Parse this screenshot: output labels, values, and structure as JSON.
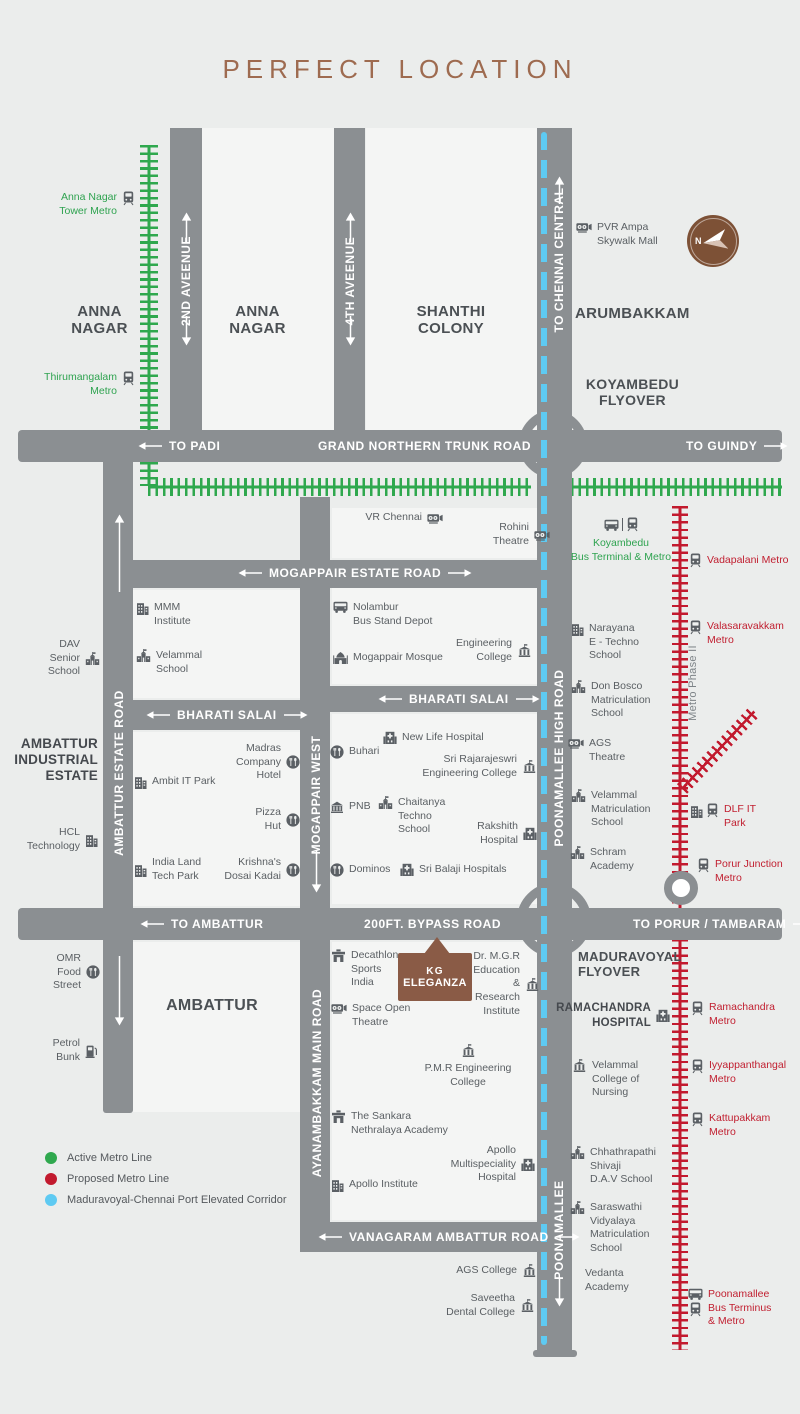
{
  "title": "PERFECT LOCATION",
  "compass": {
    "north_label": "N"
  },
  "project_marker": {
    "name_line1": "KG",
    "name_line2": "ELEGANZA"
  },
  "colors": {
    "active_metro": "#2fa84e",
    "proposed_metro": "#c21a2e",
    "elevated_corridor": "#5ecaf2",
    "road": "#8b8f92",
    "brand_brown": "#8a5b46",
    "title_brown": "#9e6b50"
  },
  "legend": {
    "items": [
      {
        "label": "Active Metro Line",
        "color": "#2fa84e"
      },
      {
        "label": "Proposed Metro Line",
        "color": "#c21a2e"
      },
      {
        "label": "Maduravoyal-Chennai Port Elevated Corridor",
        "color": "#5ecaf2"
      }
    ]
  },
  "road_labels": [
    {
      "id": "to-padi",
      "t": "TO PADI",
      "x": 138,
      "y": 439,
      "al": 1
    },
    {
      "id": "grand-northern-trunk-road",
      "t": "GRAND NORTHERN TRUNK ROAD",
      "x": 318,
      "y": 439
    },
    {
      "id": "to-guindy",
      "t": "TO GUINDY",
      "x": 686,
      "y": 439,
      "ar": 1
    },
    {
      "id": "mogappair-estate-road",
      "t": "MOGAPPAIR ESTATE ROAD",
      "x": 238,
      "y": 566,
      "al": 1,
      "ar": 1
    },
    {
      "id": "bharati-salai-west",
      "t": "BHARATI SALAI",
      "x": 146,
      "y": 708,
      "al": 1,
      "ar": 1
    },
    {
      "id": "bharati-salai-east",
      "t": "BHARATI SALAI",
      "x": 378,
      "y": 692,
      "al": 1,
      "ar": 1
    },
    {
      "id": "to-ambattur",
      "t": "TO AMBATTUR",
      "x": 140,
      "y": 917,
      "al": 1
    },
    {
      "id": "200ft-bypass-road",
      "t": "200FT. BYPASS ROAD",
      "x": 364,
      "y": 917
    },
    {
      "id": "to-porur-tambaram",
      "t": "TO PORUR / TAMBARAM",
      "x": 633,
      "y": 917,
      "ar": 1
    },
    {
      "id": "vanagaram-ambattur-road",
      "t": "VANAGARAM AMBATTUR ROAD",
      "x": 318,
      "y": 1230,
      "al": 1,
      "ar": 1
    },
    {
      "id": "2nd-avenue",
      "t": "2ND AVEENUE",
      "v": 1,
      "x": 186,
      "cy": 281
    },
    {
      "id": "4th-avenue",
      "t": "4TH AVEENUE",
      "v": 1,
      "x": 350,
      "cy": 281
    },
    {
      "id": "to-chennai-central",
      "t": "TO CHENNAI CENTRAL",
      "v": 1,
      "x": 559,
      "cy": 260
    },
    {
      "id": "ambattur-estate-road",
      "t": "AMBATTUR ESTATE ROAD",
      "v": 1,
      "x": 119,
      "cy": 773
    },
    {
      "id": "mogappair-west",
      "t": "MOGAPPAIR WEST",
      "v": 1,
      "x": 316,
      "cy": 795
    },
    {
      "id": "poonamallee-high-road",
      "t": "POONAMALLEE HIGH ROAD",
      "v": 1,
      "x": 559,
      "cy": 758
    },
    {
      "id": "ayanambakkam-main-road",
      "t": "AYANAMBAKKAM MAIN ROAD",
      "v": 1,
      "x": 317,
      "cy": 1083
    },
    {
      "id": "poonamallee",
      "t": "POONAMALLEE",
      "v": 1,
      "x": 559,
      "cy": 1230
    },
    {
      "id": "metro-phase-2",
      "t": "Metro Phase II",
      "v": 1,
      "x": 693,
      "cy": 683,
      "cls": "gray"
    }
  ],
  "area_labels": [
    {
      "id": "anna-nagar-west",
      "t": [
        "ANNA",
        "NAGAR"
      ],
      "x": 57,
      "y": 303,
      "w": 85,
      "a": "c"
    },
    {
      "id": "anna-nagar",
      "t": [
        "ANNA",
        "NAGAR"
      ],
      "x": 215,
      "y": 303,
      "w": 85,
      "a": "c"
    },
    {
      "id": "shanthi-colony",
      "t": [
        "SHANTHI",
        "COLONY"
      ],
      "x": 405,
      "y": 303,
      "w": 92,
      "a": "c"
    },
    {
      "id": "arumbakkam",
      "t": [
        "ARUMBAKKAM"
      ],
      "x": 575,
      "y": 305,
      "w": 130,
      "a": "l"
    },
    {
      "id": "koyambedu-flyover",
      "t": [
        "KOYAMBEDU",
        "FLYOVER"
      ],
      "x": 580,
      "y": 376,
      "w": 105,
      "a": "c",
      "sz": 14
    },
    {
      "id": "ambattur",
      "t": [
        "AMBATTUR"
      ],
      "x": 162,
      "y": 997,
      "w": 100,
      "a": "c",
      "sz": 16
    },
    {
      "id": "maduravoyal-flyover",
      "t": [
        "MADURAVOYAL",
        "FLYOVER"
      ],
      "x": 578,
      "y": 949,
      "w": 130,
      "a": "l",
      "sz": 13
    }
  ],
  "landmarks": [
    {
      "id": "anna-nagar-tower-metro",
      "t": [
        "Anna Nagar",
        "Tower Metro"
      ],
      "x": 40,
      "y": 191,
      "w": 95,
      "a": "r",
      "c": "g",
      "i": "train",
      "s": "r"
    },
    {
      "id": "thirumangalam-metro",
      "t": [
        "Thirumangalam",
        "Metro"
      ],
      "x": 25,
      "y": 371,
      "w": 110,
      "a": "r",
      "c": "g",
      "i": "train",
      "s": "r"
    },
    {
      "id": "pvr-ampa-skywalk-mall",
      "t": [
        "PVR Ampa",
        "Skywalk Mall"
      ],
      "x": 576,
      "y": 221,
      "w": 100,
      "a": "l",
      "i": "cinema",
      "s": "l"
    },
    {
      "id": "vr-chennai",
      "t": [
        "VR Chennai"
      ],
      "x": 363,
      "y": 511,
      "w": 80,
      "a": "r",
      "i": "cinema",
      "s": "r",
      "vc": 1
    },
    {
      "id": "rohini-theatre",
      "t": [
        "Rohini",
        "Theatre"
      ],
      "x": 460,
      "y": 521,
      "w": 90,
      "a": "r",
      "i": "cinema",
      "s": "r",
      "vc": 1
    },
    {
      "id": "koyambedu-bus-terminal-metro",
      "t": [
        "Koyambedu",
        "Bus Terminal & Metro"
      ],
      "x": 565,
      "y": 517,
      "w": 112,
      "a": "c",
      "c": "g",
      "i": "bus|train",
      "s": "t"
    },
    {
      "id": "vadapalani-metro",
      "t": [
        "Vadapalani Metro"
      ],
      "x": 689,
      "y": 553,
      "w": 100,
      "a": "l",
      "c": "r",
      "i": "train",
      "s": "l",
      "vc": 1
    },
    {
      "id": "valasaravakkam-metro",
      "t": [
        "Valasaravakkam",
        "Metro"
      ],
      "x": 689,
      "y": 620,
      "w": 100,
      "a": "l",
      "c": "r",
      "i": "train",
      "s": "l"
    },
    {
      "id": "mmm-institute",
      "t": [
        "MMM",
        "Institute"
      ],
      "x": 136,
      "y": 601,
      "w": 75,
      "a": "l",
      "i": "building",
      "s": "l"
    },
    {
      "id": "velammal-school",
      "t": [
        "Velammal",
        "School"
      ],
      "x": 136,
      "y": 649,
      "w": 75,
      "a": "l",
      "i": "school",
      "s": "l"
    },
    {
      "id": "nolambur-bus-stand-depot",
      "t": [
        "Nolambur",
        "Bus Stand Depot"
      ],
      "x": 333,
      "y": 601,
      "w": 100,
      "a": "l",
      "i": "bus",
      "s": "l"
    },
    {
      "id": "mogappair-mosque",
      "t": [
        "Mogappair Mosque"
      ],
      "x": 333,
      "y": 651,
      "w": 112,
      "a": "l",
      "i": "mosque",
      "s": "l",
      "vc": 1
    },
    {
      "id": "engineering-college",
      "t": [
        "Engineering",
        "College"
      ],
      "x": 435,
      "y": 637,
      "w": 97,
      "a": "r",
      "i": "college",
      "s": "r",
      "vc": 1
    },
    {
      "id": "dav-senior-school",
      "t": [
        "DAV",
        "Senior",
        "School"
      ],
      "x": 28,
      "y": 638,
      "w": 72,
      "a": "r",
      "i": "school",
      "s": "r",
      "vc": 1
    },
    {
      "id": "narayana-e-techno-school",
      "t": [
        "Narayana",
        "E - Techno",
        "School"
      ],
      "x": 571,
      "y": 622,
      "w": 80,
      "a": "l",
      "i": "building",
      "s": "l"
    },
    {
      "id": "don-bosco-matriculation-school",
      "t": [
        "Don Bosco",
        "Matriculation",
        "School"
      ],
      "x": 571,
      "y": 680,
      "w": 85,
      "a": "l",
      "i": "school",
      "s": "l"
    },
    {
      "id": "ags-theatre",
      "t": [
        "AGS",
        "Theatre"
      ],
      "x": 568,
      "y": 737,
      "w": 65,
      "a": "l",
      "i": "cinema",
      "s": "l"
    },
    {
      "id": "velammal-matriculation-school",
      "t": [
        "Velammal",
        "Matriculation",
        "School"
      ],
      "x": 571,
      "y": 789,
      "w": 85,
      "a": "l",
      "i": "school",
      "s": "l"
    },
    {
      "id": "dlf-it-park",
      "t": [
        "DLF IT",
        "Park"
      ],
      "x": 690,
      "y": 803,
      "w": 62,
      "a": "l",
      "c": "r",
      "i": "building+train",
      "s": "l"
    },
    {
      "id": "schram-academy",
      "t": [
        "Schram",
        "Academy"
      ],
      "x": 570,
      "y": 846,
      "w": 70,
      "a": "l",
      "i": "school",
      "s": "l"
    },
    {
      "id": "porur-junction-metro",
      "t": [
        "Porur Junction",
        "Metro"
      ],
      "x": 697,
      "y": 858,
      "w": 95,
      "a": "l",
      "c": "r",
      "i": "train",
      "s": "l"
    },
    {
      "id": "ambattur-industrial-estate",
      "t": [
        "AMBATTUR",
        "INDUSTRIAL",
        "ESTATE"
      ],
      "x": 8,
      "y": 736,
      "w": 90,
      "a": "r",
      "c": "bb",
      "s": "n"
    },
    {
      "id": "ambit-it-park",
      "t": [
        "Ambit IT Park"
      ],
      "x": 134,
      "y": 775,
      "w": 90,
      "a": "l",
      "i": "building",
      "s": "l",
      "vc": 1
    },
    {
      "id": "madras-company-hotel",
      "t": [
        "Madras",
        "Company",
        "Hotel"
      ],
      "x": 210,
      "y": 742,
      "w": 90,
      "a": "r",
      "i": "food",
      "s": "r",
      "vc": 1
    },
    {
      "id": "pizza-hut",
      "t": [
        "Pizza",
        "Hut"
      ],
      "x": 225,
      "y": 806,
      "w": 75,
      "a": "r",
      "i": "food",
      "s": "r",
      "vc": 1
    },
    {
      "id": "hcl-technology",
      "t": [
        "HCL",
        "Technology"
      ],
      "x": 18,
      "y": 826,
      "w": 80,
      "a": "r",
      "i": "building",
      "s": "r",
      "vc": 1
    },
    {
      "id": "india-land-tech-park",
      "t": [
        "India Land",
        "Tech Park"
      ],
      "x": 134,
      "y": 856,
      "w": 80,
      "a": "l",
      "i": "building",
      "s": "l",
      "vc": 1
    },
    {
      "id": "krishnas-dosai-kadai",
      "t": [
        "Krishna's",
        "Dosai Kadai"
      ],
      "x": 205,
      "y": 856,
      "w": 95,
      "a": "r",
      "i": "food",
      "s": "r",
      "vc": 1
    },
    {
      "id": "new-life-hospital",
      "t": [
        "New Life Hospital"
      ],
      "x": 383,
      "y": 731,
      "w": 115,
      "a": "l",
      "i": "hospital",
      "s": "l",
      "vc": 1
    },
    {
      "id": "buhari",
      "t": [
        "Buhari"
      ],
      "x": 330,
      "y": 745,
      "w": 60,
      "a": "l",
      "i": "food",
      "s": "l",
      "vc": 1
    },
    {
      "id": "sri-rajarajeswri-engineering-college",
      "t": [
        "Sri Rajarajeswri",
        "Engineering College"
      ],
      "x": 420,
      "y": 753,
      "w": 117,
      "a": "r",
      "i": "college",
      "s": "r",
      "vc": 1
    },
    {
      "id": "pnb",
      "t": [
        "PNB"
      ],
      "x": 330,
      "y": 800,
      "w": 55,
      "a": "l",
      "i": "bank",
      "s": "l",
      "vc": 1
    },
    {
      "id": "chaitanya-techno-school",
      "t": [
        "Chaitanya",
        "Techno",
        "School"
      ],
      "x": 378,
      "y": 796,
      "w": 80,
      "a": "l",
      "i": "school",
      "s": "l"
    },
    {
      "id": "rakshith-hospital",
      "t": [
        "Rakshith",
        "Hospital"
      ],
      "x": 448,
      "y": 820,
      "w": 89,
      "a": "r",
      "i": "hospital",
      "s": "r",
      "vc": 1
    },
    {
      "id": "dominos",
      "t": [
        "Dominos"
      ],
      "x": 330,
      "y": 863,
      "w": 70,
      "a": "l",
      "i": "food",
      "s": "l",
      "vc": 1
    },
    {
      "id": "sri-balaji-hospitals",
      "t": [
        "Sri Balaji Hospitals"
      ],
      "x": 400,
      "y": 863,
      "w": 120,
      "a": "l",
      "i": "hospital",
      "s": "l",
      "vc": 1
    },
    {
      "id": "omr-food-street",
      "t": [
        "OMR",
        "Food",
        "Street"
      ],
      "x": 30,
      "y": 952,
      "w": 70,
      "a": "r",
      "i": "food",
      "s": "r",
      "vc": 1
    },
    {
      "id": "petrol-bunk",
      "t": [
        "Petrol",
        "Bunk"
      ],
      "x": 26,
      "y": 1037,
      "w": 72,
      "a": "r",
      "i": "petrol",
      "s": "r",
      "vc": 1
    },
    {
      "id": "decathlon-sports-india",
      "t": [
        "Decathlon",
        "Sports",
        "India"
      ],
      "x": 331,
      "y": 949,
      "w": 80,
      "a": "l",
      "i": "store",
      "s": "l"
    },
    {
      "id": "space-open-theatre",
      "t": [
        "Space Open",
        "Theatre"
      ],
      "x": 331,
      "y": 1002,
      "w": 90,
      "a": "l",
      "i": "cinema",
      "s": "l"
    },
    {
      "id": "dr-mgr-education-research-institute",
      "t": [
        "Dr. M.G.R",
        "Education",
        "&",
        "Research",
        "Institute"
      ],
      "x": 455,
      "y": 950,
      "w": 85,
      "a": "r",
      "i": "college",
      "s": "r",
      "vc": 1
    },
    {
      "id": "pmr-engineering-college",
      "t": [
        "P.M.R Engineering",
        "College"
      ],
      "x": 418,
      "y": 1044,
      "w": 100,
      "a": "c",
      "i": "college",
      "s": "t"
    },
    {
      "id": "sankara-nethralaya-academy",
      "t": [
        "The Sankara",
        "Nethralaya Academy"
      ],
      "x": 331,
      "y": 1110,
      "w": 115,
      "a": "l",
      "i": "store",
      "s": "l"
    },
    {
      "id": "apollo-multispeciality-hospital",
      "t": [
        "Apollo",
        "Multispeciality",
        "Hospital"
      ],
      "x": 448,
      "y": 1144,
      "w": 87,
      "a": "r",
      "i": "hospital",
      "s": "r",
      "vc": 1
    },
    {
      "id": "apollo-institute",
      "t": [
        "Apollo Institute"
      ],
      "x": 331,
      "y": 1178,
      "w": 105,
      "a": "l",
      "i": "building",
      "s": "l",
      "vc": 1
    },
    {
      "id": "ramachandra-hospital",
      "t": [
        "RAMACHANDRA",
        "HOSPITAL"
      ],
      "x": 558,
      "y": 1001,
      "w": 112,
      "a": "r",
      "c": "b",
      "i": "hospital",
      "s": "r",
      "vc": 1
    },
    {
      "id": "ramachandra-metro",
      "t": [
        "Ramachandra",
        "Metro"
      ],
      "x": 691,
      "y": 1001,
      "w": 95,
      "a": "l",
      "c": "r",
      "i": "train",
      "s": "l"
    },
    {
      "id": "velammal-college-of-nursing",
      "t": [
        "Velammal",
        "College of",
        "Nursing"
      ],
      "x": 572,
      "y": 1059,
      "w": 80,
      "a": "l",
      "i": "college",
      "s": "l"
    },
    {
      "id": "iyyappanthangal-metro",
      "t": [
        "Iyyappanthangal",
        "Metro"
      ],
      "x": 691,
      "y": 1059,
      "w": 105,
      "a": "l",
      "c": "r",
      "i": "train",
      "s": "l"
    },
    {
      "id": "kattupakkam-metro",
      "t": [
        "Kattupakkam",
        "Metro"
      ],
      "x": 691,
      "y": 1112,
      "w": 95,
      "a": "l",
      "c": "r",
      "i": "train",
      "s": "l"
    },
    {
      "id": "chhathrapathi-shivaji-dav-school",
      "t": [
        "Chhathrapathi",
        "Shivaji",
        "D.A.V School"
      ],
      "x": 570,
      "y": 1146,
      "w": 90,
      "a": "l",
      "i": "school",
      "s": "l"
    },
    {
      "id": "saraswathi-vidyalaya-matriculation-school",
      "t": [
        "Saraswathi",
        "Vidyalaya",
        "Matriculation",
        "School"
      ],
      "x": 570,
      "y": 1201,
      "w": 90,
      "a": "l",
      "i": "school",
      "s": "l"
    },
    {
      "id": "vedanta-academy",
      "t": [
        "Vedanta",
        "Academy"
      ],
      "x": 585,
      "y": 1267,
      "w": 75,
      "a": "l",
      "s": "n"
    },
    {
      "id": "poonamallee-bus-terminus-metro",
      "t": [
        "Poonamallee",
        "Bus Terminus",
        "& Metro"
      ],
      "x": 688,
      "y": 1288,
      "w": 100,
      "a": "l",
      "c": "r",
      "i": "bus/train",
      "s": "l"
    },
    {
      "id": "ags-college",
      "t": [
        "AGS College"
      ],
      "x": 440,
      "y": 1264,
      "w": 97,
      "a": "r",
      "i": "college",
      "s": "r",
      "vc": 1
    },
    {
      "id": "saveetha-dental-college",
      "t": [
        "Saveetha",
        "Dental College"
      ],
      "x": 430,
      "y": 1292,
      "w": 105,
      "a": "r",
      "i": "college",
      "s": "r",
      "vc": 1
    }
  ]
}
